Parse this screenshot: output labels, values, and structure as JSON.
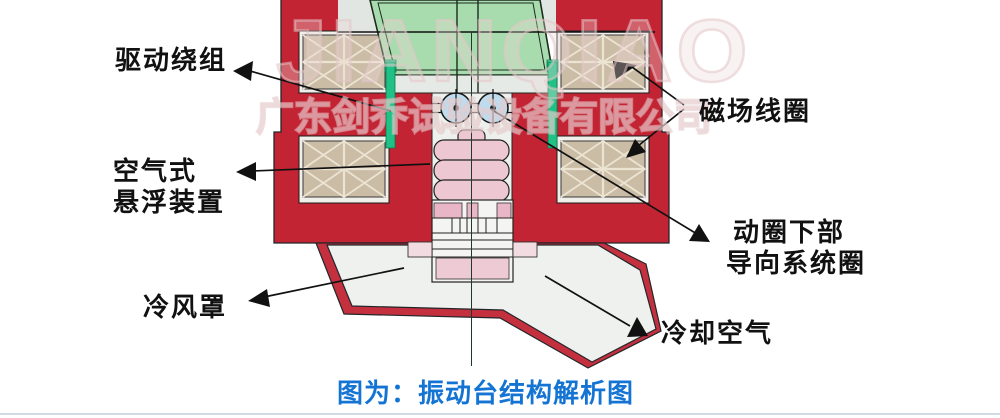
{
  "watermark": {
    "brand": "JIANQIAO",
    "company": "广东剑乔试验设备有限公司"
  },
  "caption": {
    "text": "图为：振动台结构解析图",
    "color": "#1474d4"
  },
  "labels": {
    "drive_winding": "驱动绕组",
    "air_suspension_line1": "空气式",
    "air_suspension_line2": "悬浮装置",
    "field_coil": "磁场线圈",
    "lower_guide_line1": "动圈下部",
    "lower_guide_line2": "导向系统圈",
    "cooling_hood": "冷风罩",
    "cooling_air": "冷却空气"
  },
  "diagram": {
    "subject": "电动振动台剖面结构图",
    "colors": {
      "magnet_body_red": "#c32433",
      "hood_rim_red": "#c5303f",
      "coil_tan": "#cbbca6",
      "armature_green": "#a8dcae",
      "drive_coil_emerald": "#1fc184",
      "roller_blue": "#bedced",
      "bellows_pink": "#edc8d3",
      "guide_pink": "#e9b6c7",
      "caption_blue": "#1474d4",
      "pointer_black": "#111111"
    }
  }
}
